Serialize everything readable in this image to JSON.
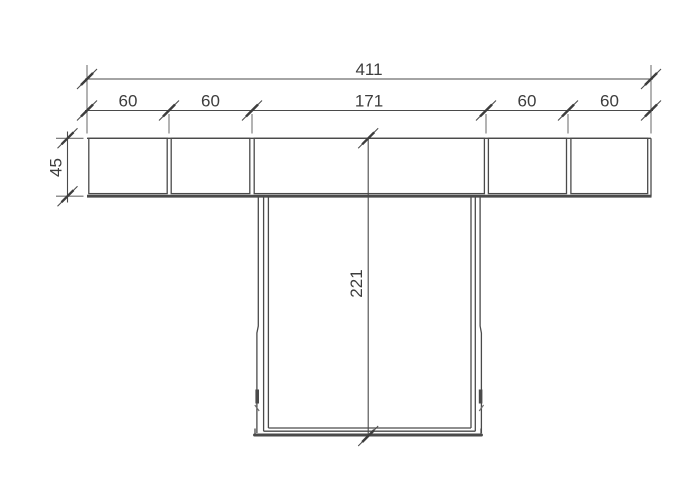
{
  "drawing": {
    "type": "technical-dimension-drawing",
    "view": "cross-section",
    "dimensions": {
      "total_width": "411",
      "segments": [
        "60",
        "60",
        "171",
        "60",
        "60"
      ],
      "flange_height": "45",
      "stem_height": "221"
    }
  },
  "colors": {
    "background": "#ffffff",
    "line": "#4a4a4a",
    "line_light": "#6e6e6e",
    "text": "#3d3d3d"
  }
}
